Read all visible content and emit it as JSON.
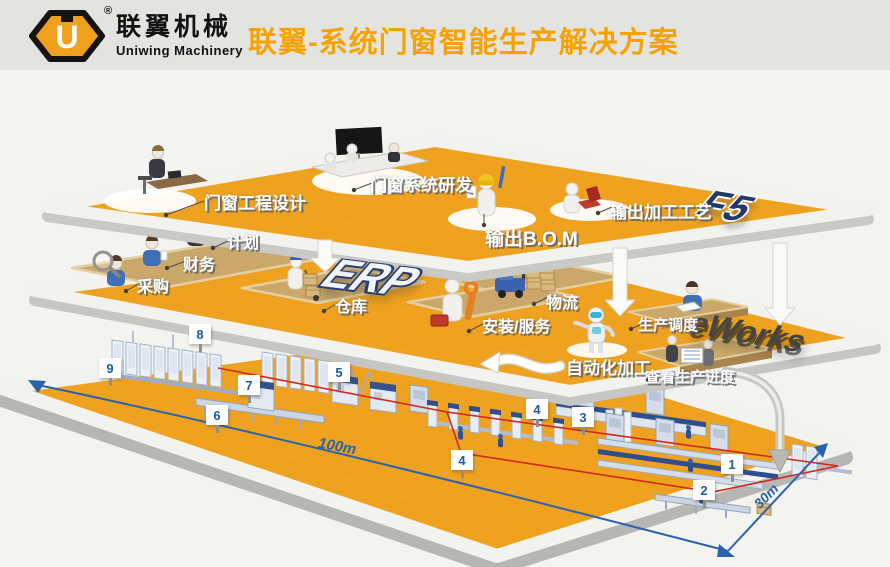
{
  "header": {
    "logo_letter": "U",
    "registered_mark": "®",
    "brand_cn": "联翼机械",
    "brand_en": "Uniwing Machinery",
    "title": "联翼-系统门窗智能生产解决方案"
  },
  "design_layer": {
    "system_label": "F5",
    "stations": [
      {
        "label": "门窗工程设计"
      },
      {
        "label": "门窗系统研发"
      },
      {
        "label": "输出B.O.M"
      },
      {
        "label": "输出加工工艺"
      }
    ]
  },
  "erp_layer": {
    "system_label": "ERP",
    "stations": [
      {
        "label": "计划"
      },
      {
        "label": "财务"
      },
      {
        "label": "采购"
      },
      {
        "label": "仓库"
      },
      {
        "label": "物流"
      },
      {
        "label": "安装/服务"
      },
      {
        "label": "生产调度"
      }
    ]
  },
  "factory_layer": {
    "system_label": "eWorks",
    "stations": [
      {
        "label": "自动化加工"
      },
      {
        "label": "查看生产进度"
      }
    ],
    "markers": [
      "8",
      "9",
      "7",
      "6",
      "5",
      "4",
      "4",
      "3",
      "1",
      "2"
    ],
    "dimensions": {
      "length": "100m",
      "depth": "30m"
    }
  },
  "colors": {
    "platform_orange": "#EFA21F",
    "accent_orange": "#F6A201",
    "dimension_blue": "#2B62AD",
    "route_red": "#D0291C"
  }
}
